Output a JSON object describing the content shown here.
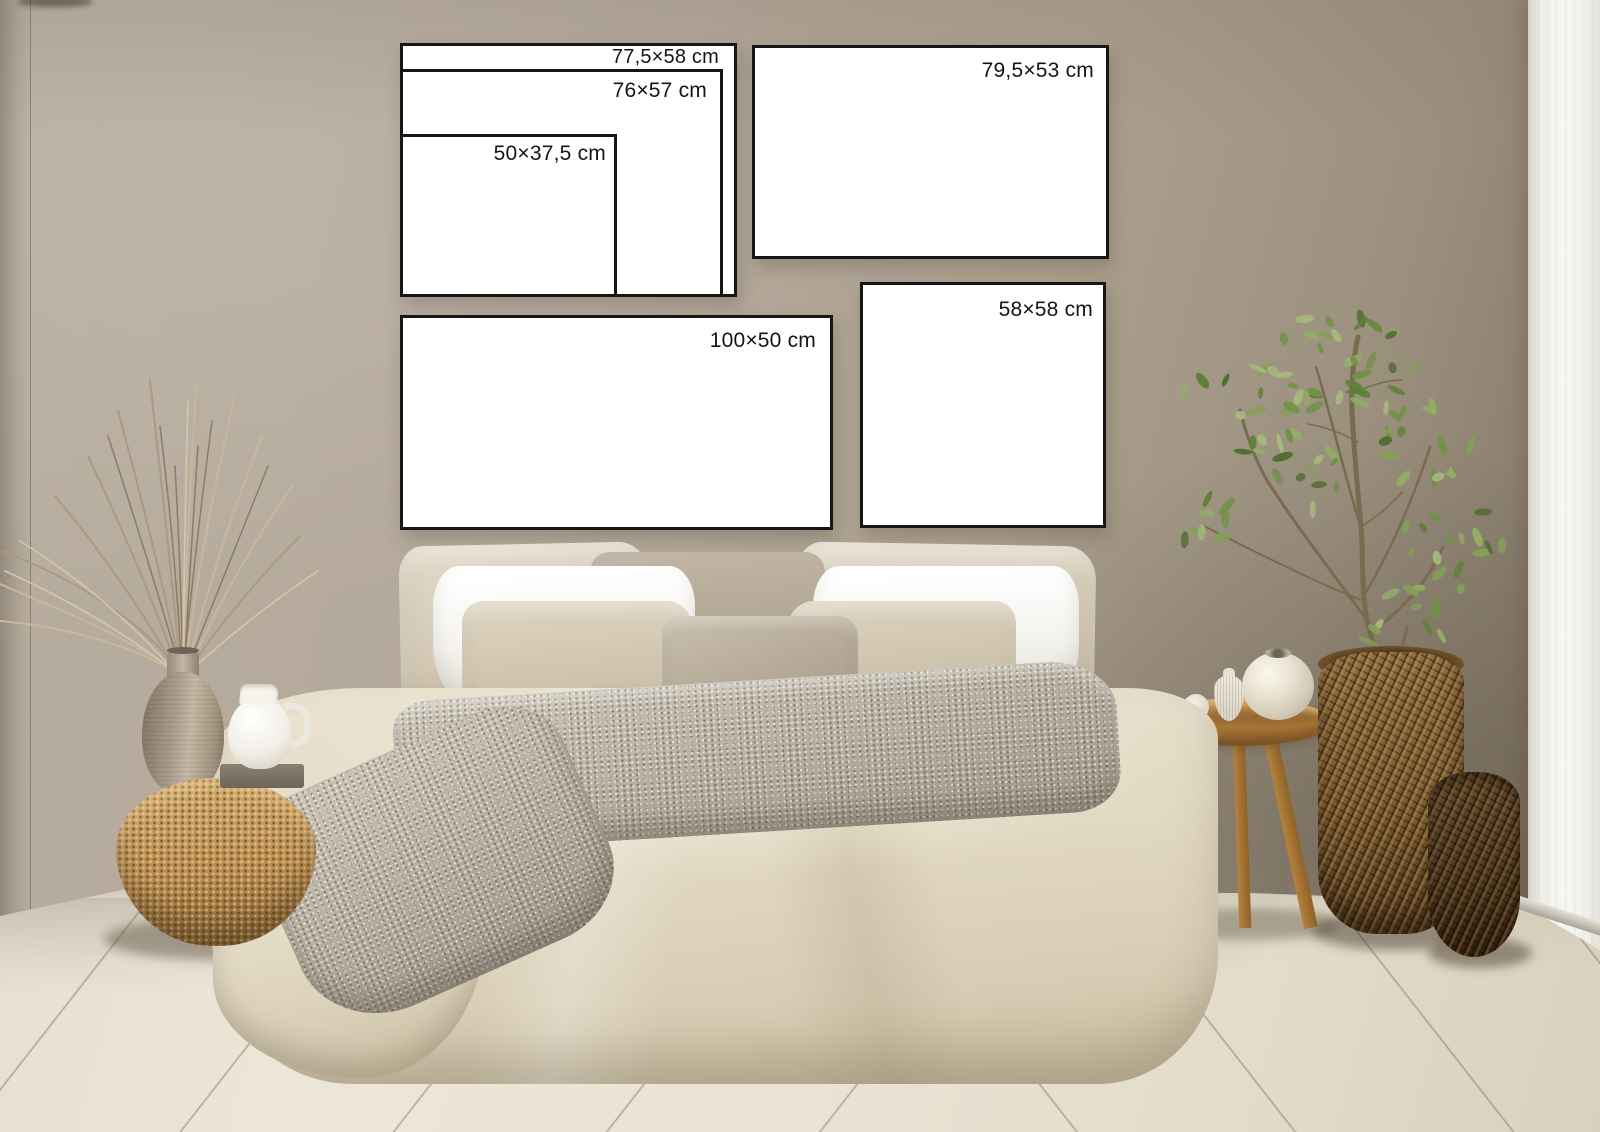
{
  "frames": [
    {
      "name": "frame-77-5x58",
      "label": "77,5×58 cm"
    },
    {
      "name": "frame-76x57",
      "label": "76×57 cm"
    },
    {
      "name": "frame-50x37-5",
      "label": "50×37,5 cm"
    },
    {
      "name": "frame-79-5x53",
      "label": "79,5×53 cm"
    },
    {
      "name": "frame-100x50",
      "label": "100×50 cm"
    },
    {
      "name": "frame-58x58",
      "label": "58×58 cm"
    }
  ],
  "colors": {
    "frame_border": "#161616",
    "frame_face": "#ffffff",
    "label_text": "#151515",
    "wall_taupe": "#b1a697",
    "wall_corner_shadow": "#7e7467",
    "wall_white": "#f5f4f1",
    "floor_cream": "#e8e2d3",
    "floor_seam": "#a59d8d",
    "duvet_linen": "#e6decb",
    "pillow_white": "#fafaf7",
    "pillow_beige": "#d7cdb9",
    "pillow_taupe": "#b3a796",
    "throw_knit": "#b8b1a4",
    "wicker_light": "#c1945a",
    "wicker_dark": "#6f5331",
    "stool_wood": "#b07c44",
    "ceramic_greige": "#ada08d",
    "ceramic_white": "#f4f1ea",
    "foliage_green": "#6d8c44",
    "grass_dried": "#b5a188"
  }
}
